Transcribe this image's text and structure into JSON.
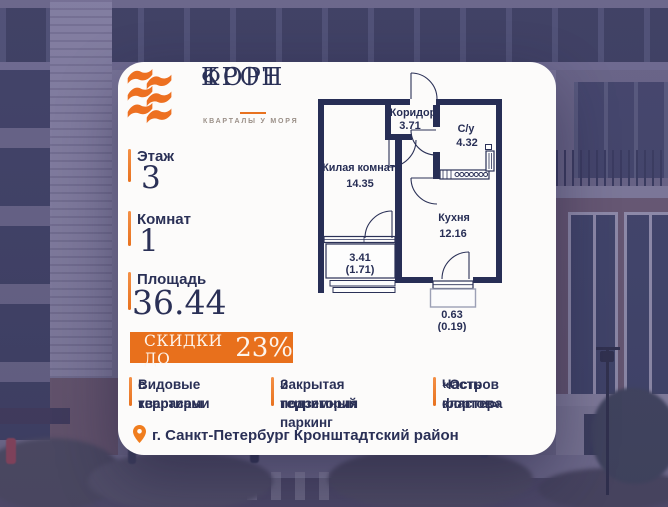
{
  "logo": {
    "name_line1": "КРОН",
    "name_line2": "ФОРТ",
    "tagline": "КВАРТАЛЫ У МОРЯ"
  },
  "stats": [
    {
      "label": "Этаж",
      "value": "3"
    },
    {
      "label": "Комнат",
      "value": "1"
    },
    {
      "label": "Площадь",
      "value": "36.44"
    }
  ],
  "discount": {
    "prefix": "СКИДКИ ДО",
    "percent": "23%"
  },
  "features": [
    {
      "line1": "Видовые квартиры",
      "line2": "с террасами"
    },
    {
      "line1": "Закрытая территория",
      "line2": "и подземный паркинг"
    },
    {
      "line1": "Часть кластера",
      "line2": "«Остров фортов»"
    }
  ],
  "location": {
    "text": "г. Санкт-Петербург Кронштадтский район"
  },
  "floor_plan": {
    "rooms": [
      {
        "name": "Коридор",
        "area": "3.71"
      },
      {
        "name": "С/у",
        "area": "4.32"
      },
      {
        "name": "Жилая комната",
        "area": "14.35"
      },
      {
        "name": "Кухня",
        "area": "12.16"
      }
    ],
    "balconies": [
      {
        "area": "3.41",
        "reduced_area": "(1.71)"
      },
      {
        "area": "0.63",
        "reduced_area": "(0.19)"
      }
    ]
  },
  "colors": {
    "accent_orange": "#E8721F",
    "navy": "#2A3056",
    "plan_wall": "#272E55"
  }
}
